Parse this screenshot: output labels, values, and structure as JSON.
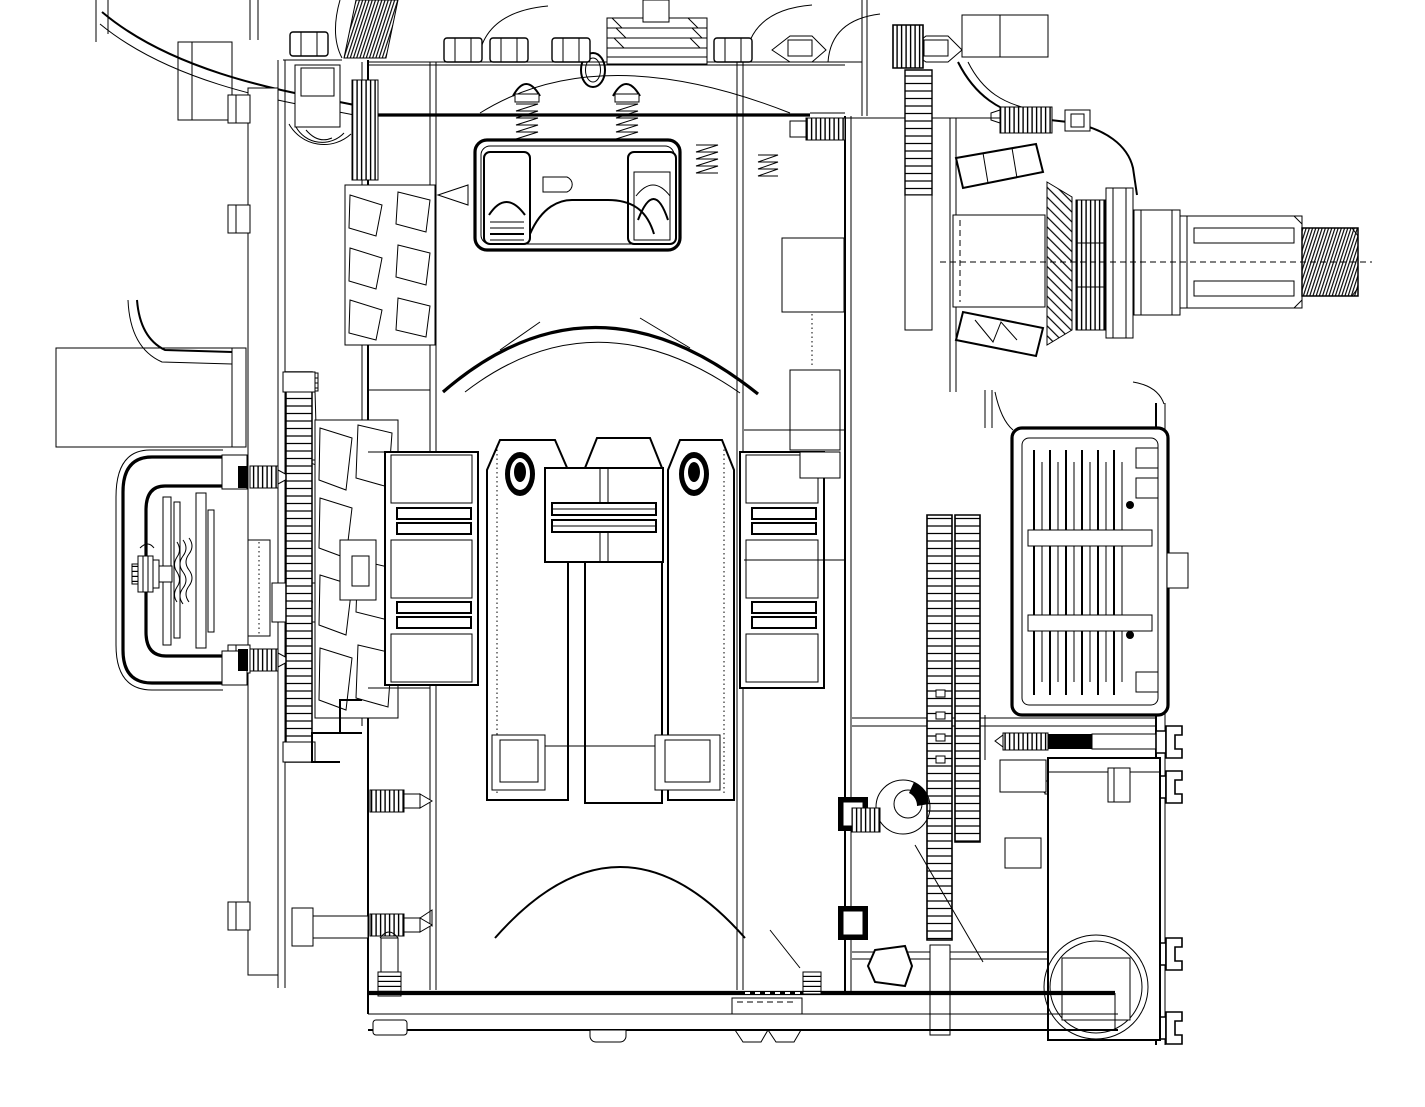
{
  "document": {
    "kind": "engineering-cad-cross-section-drawing",
    "visible_text": [],
    "palette": {
      "background": "#ffffff",
      "linework": "#000000"
    }
  },
  "canvas": {
    "width": 1425,
    "height": 1107
  },
  "components": [
    {
      "name": "top-deck-and-head-bolts"
    },
    {
      "name": "cooling-fin-stack"
    },
    {
      "name": "tappet-lifter-block"
    },
    {
      "name": "head-studs-with-springs"
    },
    {
      "name": "front-cover-pillar-and-flange"
    },
    {
      "name": "crank-pulley-c-bracket"
    },
    {
      "name": "pulley-spring-stack"
    },
    {
      "name": "cam-gear-column"
    },
    {
      "name": "fan-rotor-upper"
    },
    {
      "name": "fan-rotor-lower"
    },
    {
      "name": "crankshaft-webs-and-pins"
    },
    {
      "name": "main-bearing-block-left"
    },
    {
      "name": "main-bearing-block-right"
    },
    {
      "name": "center-main-bearing"
    },
    {
      "name": "timing-gear-train"
    },
    {
      "name": "tapered-roller-bearings"
    },
    {
      "name": "bevel-gear-teeth"
    },
    {
      "name": "output-shaft-spline"
    },
    {
      "name": "output-shaft-thread"
    },
    {
      "name": "pto-clutch-pack"
    },
    {
      "name": "idler-gear-columns"
    },
    {
      "name": "rear-housing-bottom-right"
    },
    {
      "name": "tie-bolts"
    },
    {
      "name": "oil-pan-flange"
    }
  ]
}
